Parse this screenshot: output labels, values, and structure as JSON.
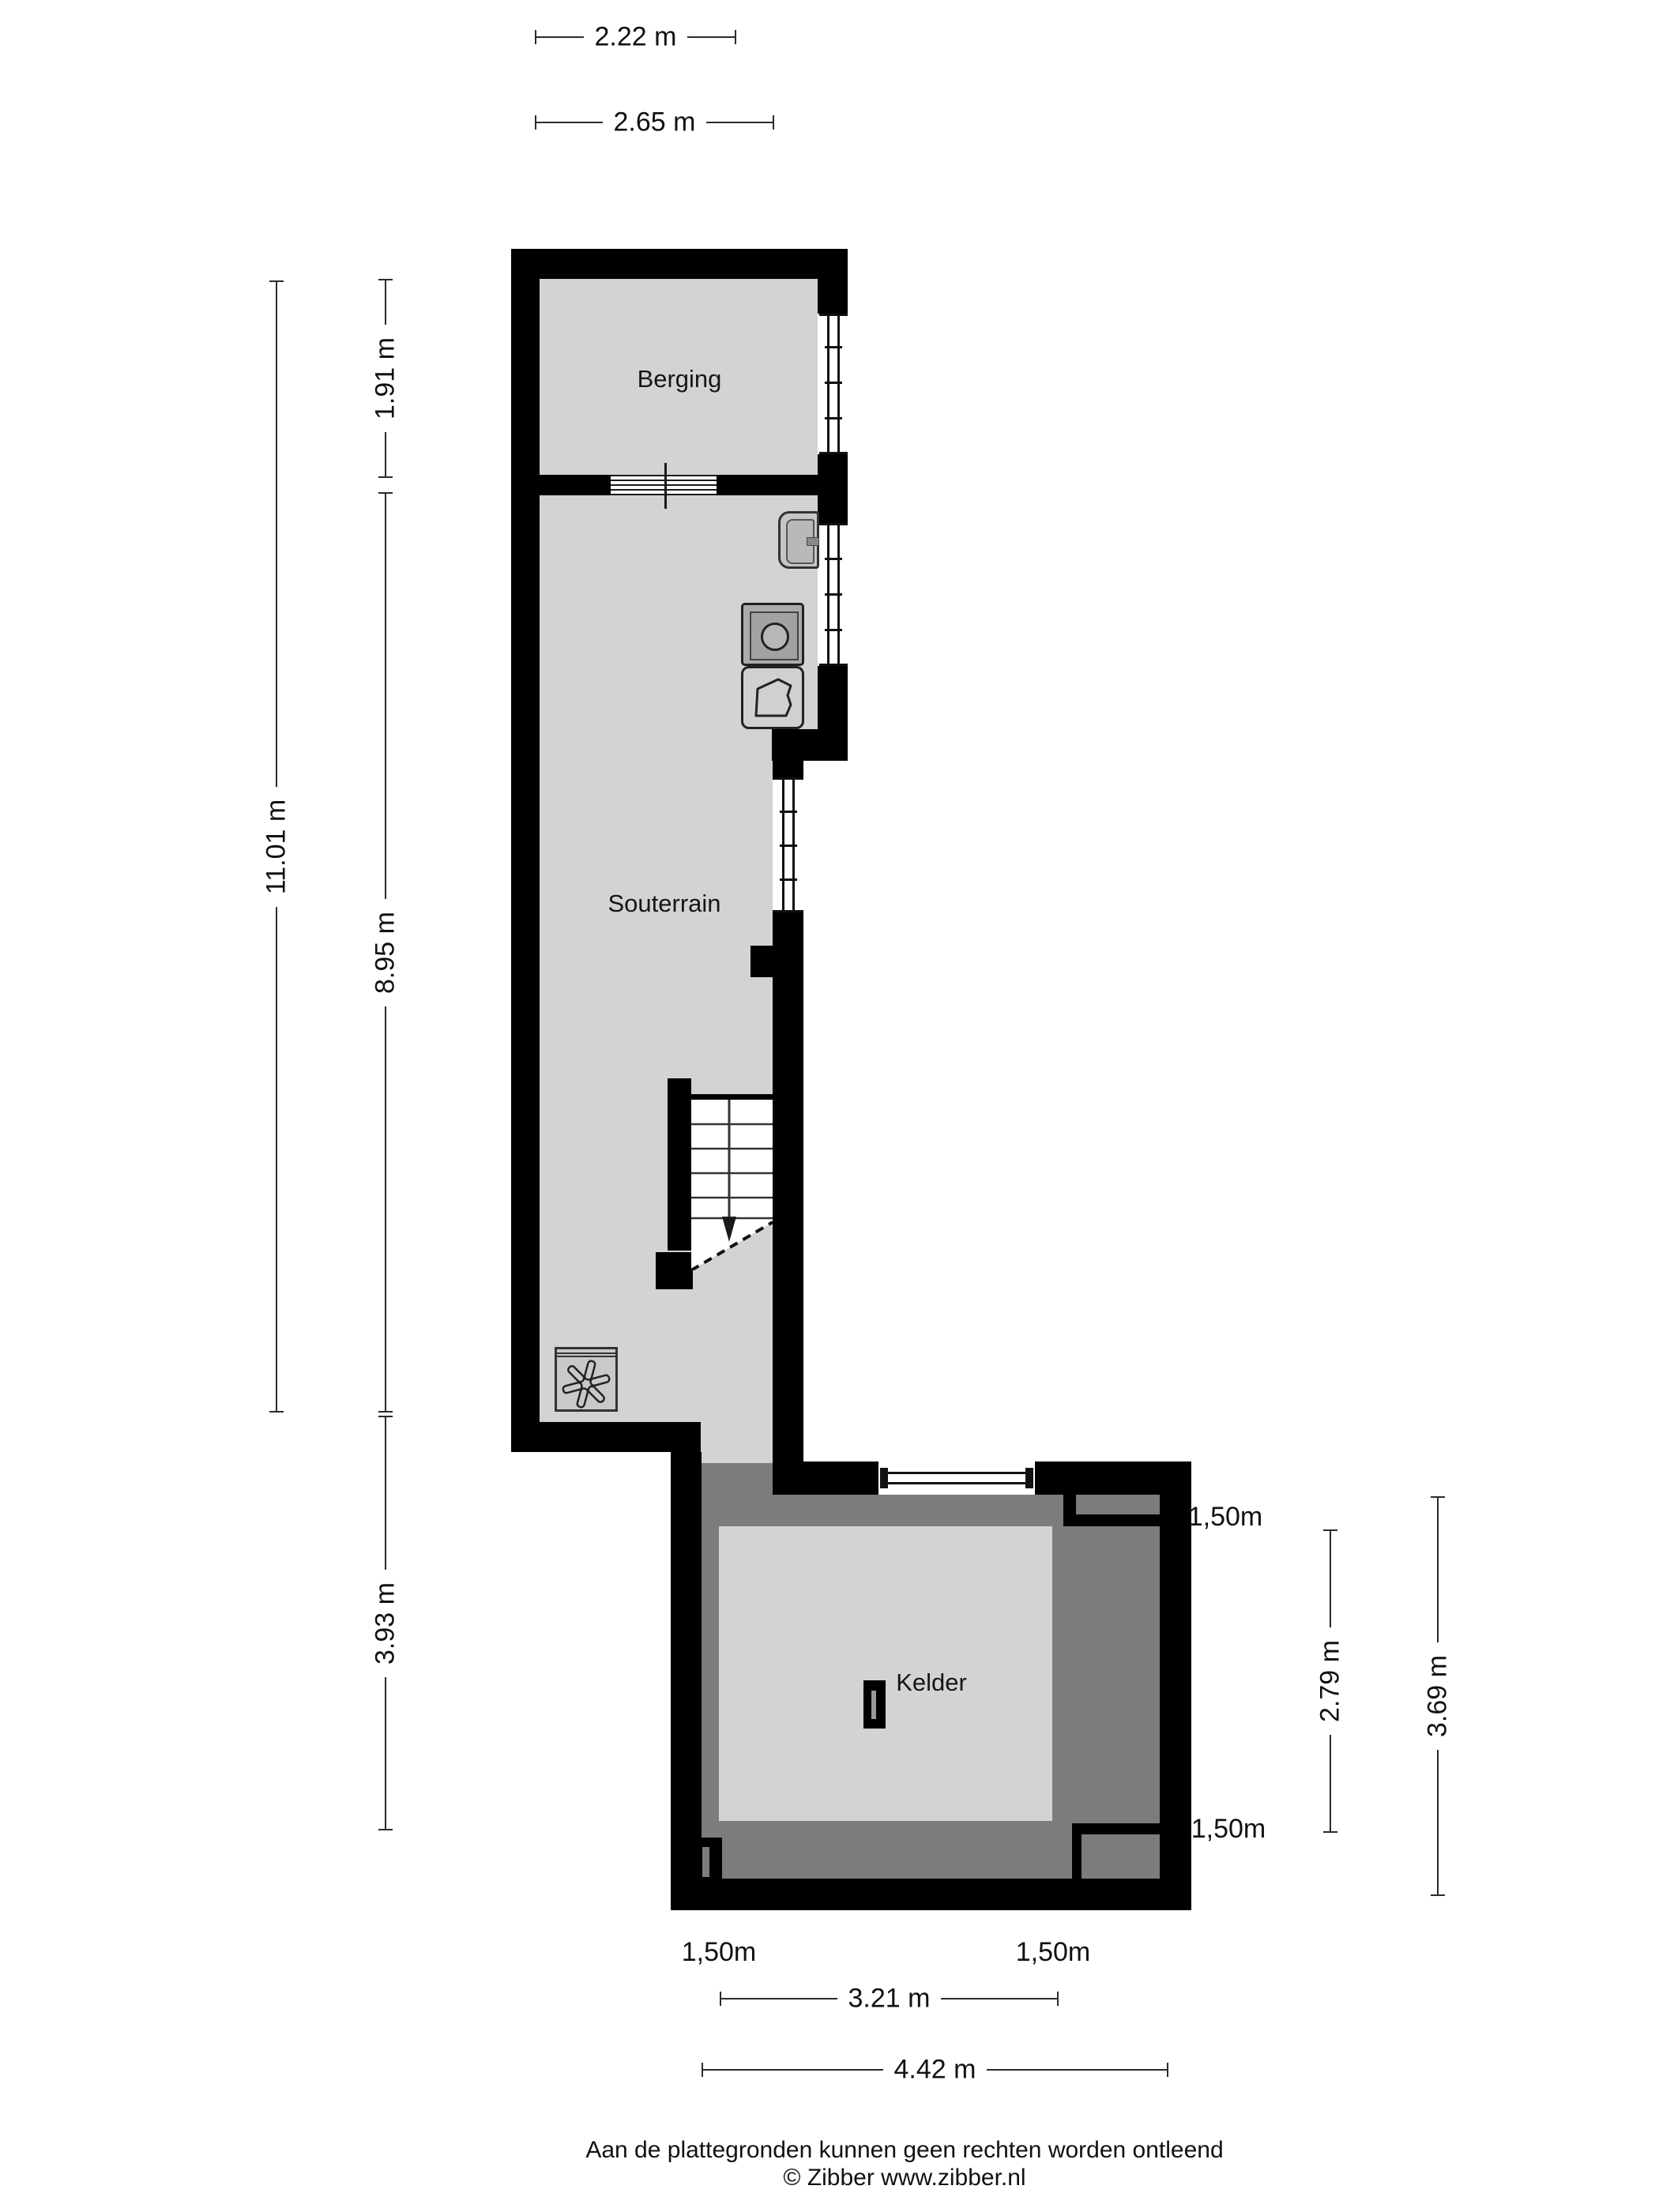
{
  "plan": {
    "rooms": {
      "berging": "Berging",
      "souterrain": "Souterrain",
      "kelder": "Kelder"
    },
    "dims": {
      "top_inner": "2.22 m",
      "top_outer": "2.65 m",
      "left_berging": "1.91 m",
      "left_total": "11.01 m",
      "left_souterrain": "8.95 m",
      "left_kelder": "3.93 m",
      "right_top": "1,50m",
      "right_kelder_inner": "2.79 m",
      "right_kelder_outer": "3.69 m",
      "right_bottom": "1,50m",
      "bottom_left": "1,50m",
      "bottom_right": "1,50m",
      "bottom_inner": "3.21 m",
      "bottom_outer": "4.42 m"
    },
    "footer": {
      "disclaimer": "Aan de plattegronden kunnen geen rechten worden ontleend",
      "credit": "© Zibber www.zibber.nl"
    },
    "colors": {
      "wall": "#000000",
      "floor": "#d3d3d3",
      "surround": "#7c7c7c",
      "background": "#ffffff",
      "dimension_text": "#111111"
    }
  }
}
